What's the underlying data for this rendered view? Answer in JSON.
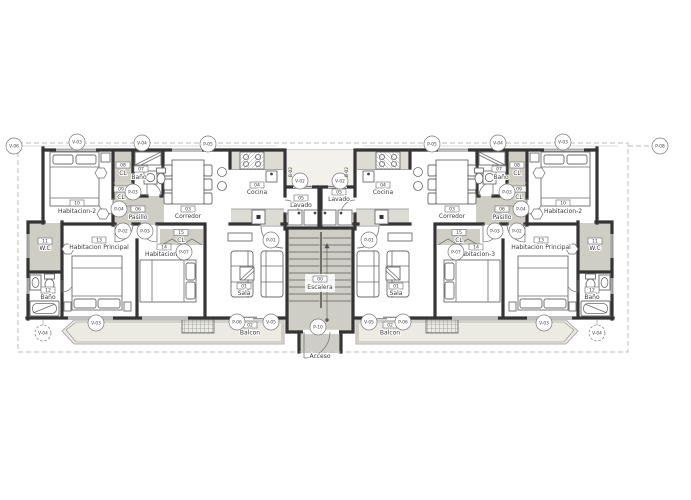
{
  "colors": {
    "wall": "#343434",
    "poche_gray": "#cfcec5",
    "counter_gray": "#dddcd4",
    "balcony_deck": "#ebeae3",
    "line_gray": "#8a8a8a",
    "text": "#3b3b3b",
    "background": "#ffffff"
  },
  "rooms": {
    "escalera": {
      "tag": "00",
      "name": "Escalera"
    },
    "sala": {
      "tag": "01",
      "name": "Sala"
    },
    "balcon": {
      "tag": "02",
      "name": "Balcon"
    },
    "corredor": {
      "tag": "03",
      "name": "Corredor"
    },
    "cocina": {
      "tag": "04",
      "name": "Cocina"
    },
    "lavado": {
      "tag": "05",
      "name": "Lavado"
    },
    "pasillo": {
      "tag": "06",
      "name": "Pasillo"
    },
    "bano": {
      "tag": "07",
      "name": "Baño"
    },
    "cl1": {
      "tag": "08",
      "name": "CL"
    },
    "cl2": {
      "tag": "09",
      "name": "CL"
    },
    "habitacion2": {
      "tag": "10",
      "name": "Habitacion-2"
    },
    "wc": {
      "tag": "11",
      "name": "W.C"
    },
    "bano2": {
      "tag": "12",
      "name": "Baño"
    },
    "habitacionPrincipal": {
      "tag": "13",
      "name": "Habitacion Principal"
    },
    "habitacion3": {
      "tag": "14",
      "name": "Habitacion-3"
    },
    "cl3": {
      "tag": "15",
      "name": "CL"
    },
    "acceso": {
      "name": "Acceso"
    }
  },
  "tags": {
    "v02": "V-02",
    "v03": "V-03",
    "v04": "V-04",
    "v05": "V-05",
    "v06": "V-06",
    "p01": "P-01",
    "p02": "P-02",
    "p03": "P-03",
    "p04": "P-04",
    "p05": "P-05",
    "p06": "P-06",
    "p07": "P-07",
    "p08": "P-08",
    "p10": "P-10",
    "b02": "B-02"
  }
}
